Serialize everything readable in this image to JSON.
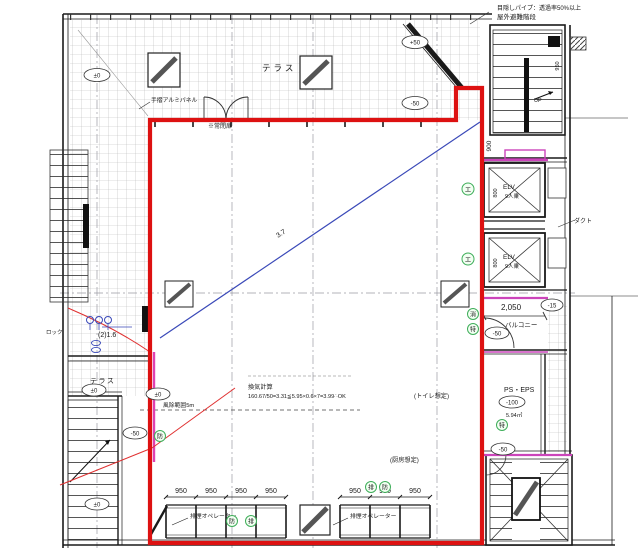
{
  "colors": {
    "boundary_red": "#dd1111",
    "thin_red": "#e03030",
    "magenta": "#cc44bb",
    "blue": "#3a49b8",
    "green": "#3fae5a",
    "line": "#1a1a1a",
    "hatch": "#b8b8b8"
  },
  "annotations": {
    "blind_pipe": "目隠しパイプ：透過率50%以上",
    "outdoor_stair": "屋外避難階段",
    "terrace": "テラス",
    "handrail_panel": "手摺アルミパネル",
    "closed_door": "※常閉扉",
    "vent_title": "換気計算",
    "vent_formula": "160.67/50=3.31≦5.95×0.6×7=3.99∴OK",
    "toilet": "(トイレ想定)",
    "kitchen": "(厨房想定)",
    "smoke_operator": "排煙オペレーター",
    "balcony": "バルコニー",
    "ps_eps": "PS・EPS",
    "ps_area": "5.94㎡",
    "duct": "ダクト",
    "wind_range": "風除範囲5m",
    "lock": "ロック",
    "blue_note": "(2)1.6",
    "slope": "3.7",
    "up": "UP",
    "elv": "ELV",
    "elv_capacity": "9人乗"
  },
  "dimensions": {
    "d900": "900",
    "d950": "950",
    "d800": "800",
    "d2050": "2,050"
  },
  "levels": {
    "zero": "±0",
    "plus50": "+50",
    "minus50": "-50",
    "minus15": "-15",
    "minus100": "-100"
  },
  "badges": {
    "elevator": "エ",
    "fire_hydrant": "消",
    "special": "特",
    "fire": "防",
    "smoke": "排"
  }
}
